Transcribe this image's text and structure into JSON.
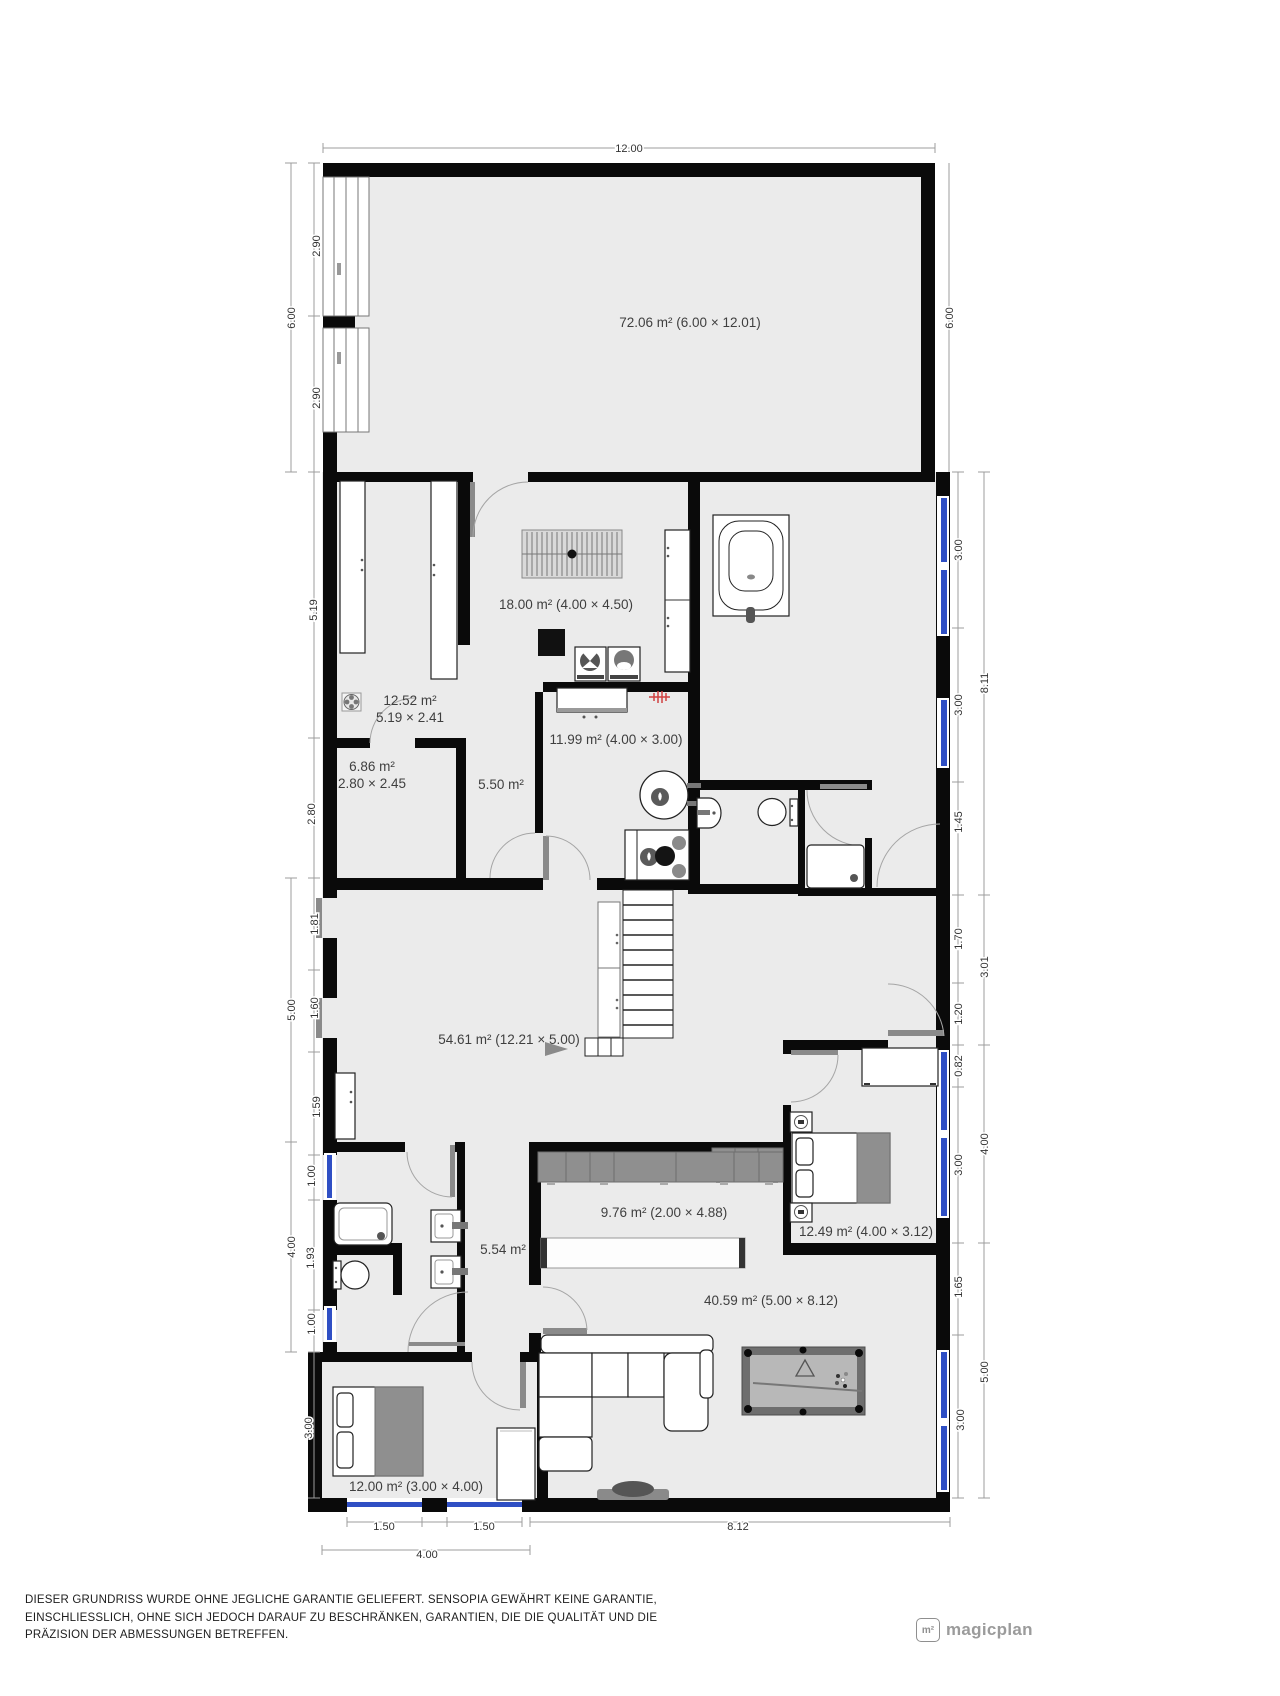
{
  "plan": {
    "rooms": {
      "top": {
        "label": "72.06 m² (6.00 × 12.01)"
      },
      "laundry": {
        "label": "18.00 m² (4.00 × 4.50)"
      },
      "closet": {
        "label": "12.52 m²",
        "sub": "5.19 × 2.41"
      },
      "kitchen": {
        "label": "11.99 m² (4.00 × 3.00)"
      },
      "hall_top": {
        "label": "5.50 m²"
      },
      "storage": {
        "label": "6.86 m²",
        "sub": "2.80 × 2.45"
      },
      "living": {
        "label": "54.61 m² (12.21 × 5.00)"
      },
      "corridor": {
        "label": "9.76 m² (2.00 × 4.88)"
      },
      "bedroom_right": {
        "label": "12.49 m² (4.00 × 3.12)"
      },
      "hall_bottom": {
        "label": "5.54 m²"
      },
      "family": {
        "label": "40.59 m² (5.00 × 8.12)"
      },
      "bedroom_bottom": {
        "label": "12.00 m² (3.00 × 4.00)"
      }
    },
    "dims": {
      "top": "12.00",
      "left": [
        "2.90",
        "6.00",
        "2.90",
        "5.19",
        "2.80",
        "1.81",
        "5.00",
        "1.60",
        "1.59",
        "1.00",
        "4.00",
        "1.93",
        "1.00",
        "3.00"
      ],
      "right": [
        "6.00",
        "3.00",
        "8.11",
        "3.00",
        "1.45",
        "1.70",
        "3.01",
        "1.20",
        "0.82",
        "4.00",
        "3.00",
        "1.65",
        "5.00",
        "3.00"
      ],
      "bottom": [
        "1.50",
        "1.50",
        "8.12",
        "4.00"
      ]
    }
  },
  "footer": {
    "line1": "DIESER GRUNDRISS WURDE OHNE JEGLICHE GARANTIE GELIEFERT. SENSOPIA GEWÄHRT KEINE GARANTIE,",
    "line2": "EINSCHLIESSLICH, OHNE SICH JEDOCH DARAUF ZU BESCHRÄNKEN, GARANTIEN, DIE DIE QUALITÄT UND DIE",
    "line3": "PRÄZISION DER ABMESSUNGEN BETREFFEN."
  },
  "logo": {
    "icon": "m²",
    "name": "magicplan"
  }
}
